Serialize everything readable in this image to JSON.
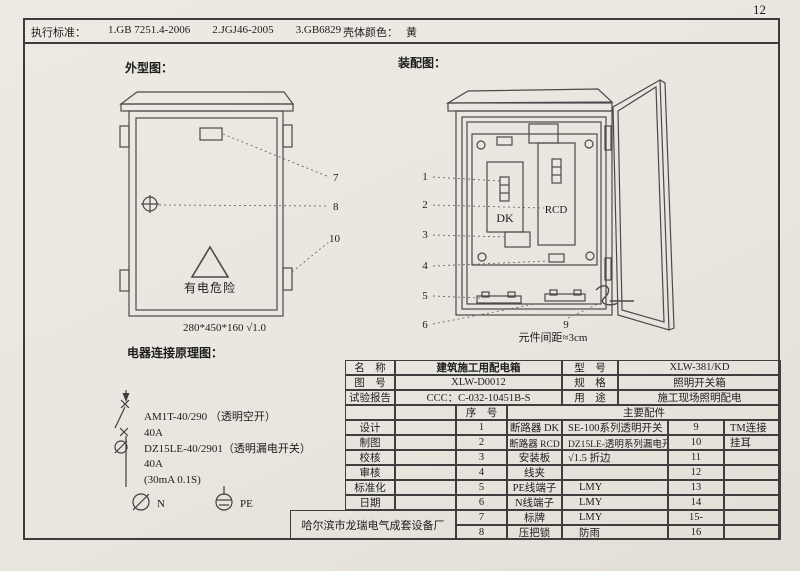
{
  "page_number": "12",
  "header": {
    "exec_label": "执行标准：",
    "standards": [
      "1.GB 7251.4-2006",
      "2.JGJ46-2005",
      "3.GB6829"
    ],
    "color_label": "壳体颜色：",
    "color_value": "黄"
  },
  "outline": {
    "title": "外型图：",
    "danger_text": "有电危险",
    "dimension": "280*450*160  √1.0",
    "callout_7": "7",
    "callout_8": "8",
    "callout_10": "10"
  },
  "assembly": {
    "title": "装配图：",
    "dk": "DK",
    "rcd": "RCD",
    "spacing_note": "元件间距≈3cm",
    "callout_1": "1",
    "callout_2": "2",
    "callout_3": "3",
    "callout_4": "4",
    "callout_5": "5",
    "callout_6": "6",
    "callout_9": "9"
  },
  "schematic": {
    "title": "电器连接原理图：",
    "lines": [
      "AM1T-40/290 （透明空开）",
      "40A",
      "DZ15LE-40/2901（透明漏电开关）",
      "40A",
      "(30mA 0.1S)"
    ],
    "n_label": "N",
    "pe_label": "PE"
  },
  "info": {
    "rows": [
      {
        "l": "名　称",
        "v": "建筑施工用配电箱",
        "l2": "型　号",
        "v2": "XLW-381/KD"
      },
      {
        "l": "图　号",
        "v": "XLW-D0012",
        "l2": "规　格",
        "v2": "照明开关箱"
      },
      {
        "l": "试验报告",
        "v": "CCC：C-032-10451B-S",
        "l2": "用　途",
        "v2": "施工现场照明配电"
      }
    ]
  },
  "parts": {
    "seq_header": "序　号",
    "main_header": "主要配件",
    "sign_labels": [
      "设计",
      "制图",
      "校核",
      "审核",
      "标准化",
      "日期"
    ],
    "rows": [
      {
        "no": "1",
        "name": "断路器 DK",
        "desc": "SE-100系列透明开关",
        "no2": "9",
        "desc2": "TM连接"
      },
      {
        "no": "2",
        "name": "断路器 RCD",
        "desc": "DZ15LE-透明系列漏电开",
        "no2": "10",
        "desc2": "挂耳"
      },
      {
        "no": "3",
        "name": "安装板",
        "desc": "√1.5 折边",
        "no2": "11",
        "desc2": ""
      },
      {
        "no": "4",
        "name": "线夹",
        "desc": "",
        "no2": "12",
        "desc2": ""
      },
      {
        "no": "5",
        "name": "PE线端子",
        "desc": "LMY",
        "no2": "13",
        "desc2": ""
      },
      {
        "no": "6",
        "name": "N线端子",
        "desc": "LMY",
        "no2": "14",
        "desc2": ""
      },
      {
        "no": "7",
        "name": "标牌",
        "desc": "LMY",
        "no2": "15-",
        "desc2": ""
      },
      {
        "no": "8",
        "name": "压把锁",
        "desc": "防雨",
        "no2": "16",
        "desc2": ""
      }
    ],
    "company": "哈尔滨市龙瑞电气成套设备厂"
  }
}
